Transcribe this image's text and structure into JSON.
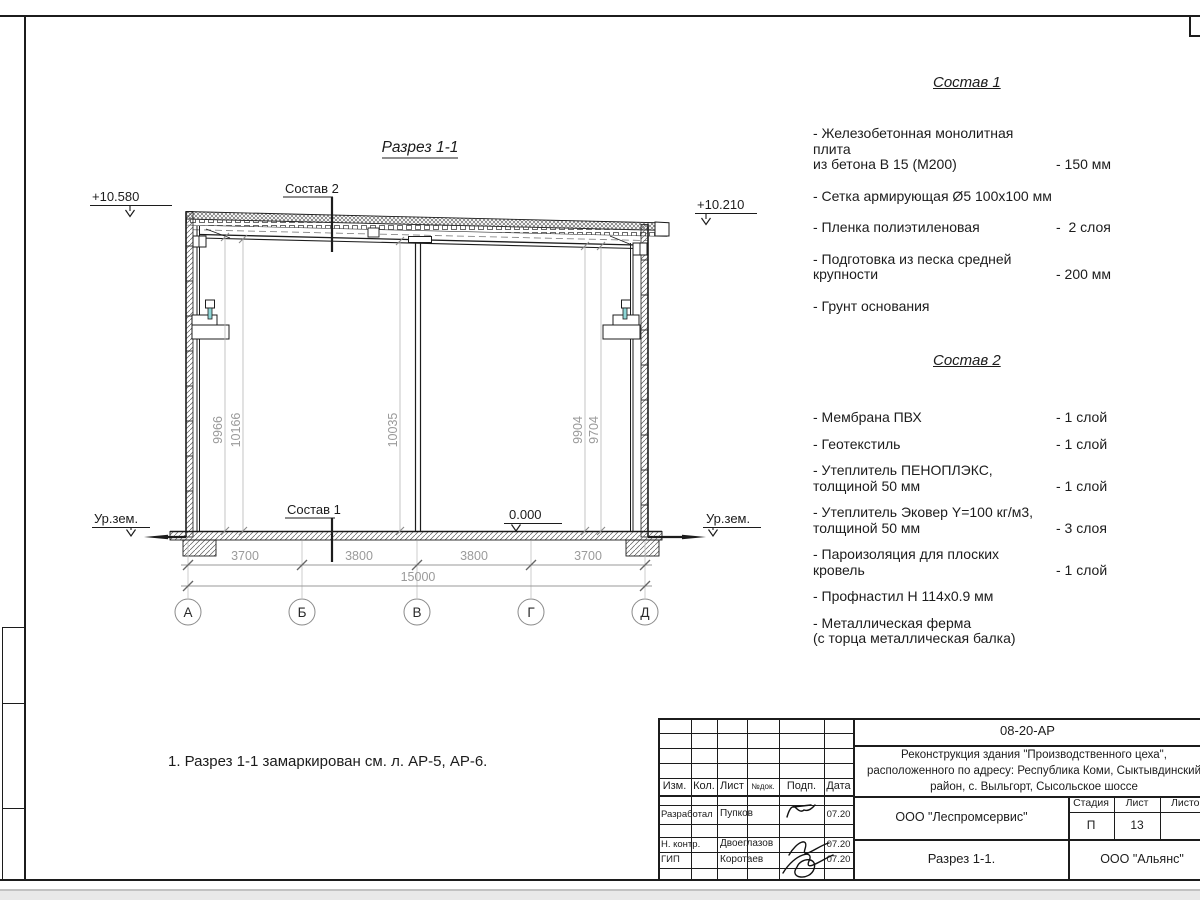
{
  "colors": {
    "line": "#1c1c1c",
    "dim_text": "#9a9a9a",
    "accent_teal": "#8ed6d6"
  },
  "drawing": {
    "title": "Разрез 1-1",
    "labels": {
      "sostav2_ref": "Состав 2",
      "sostav1_ref": "Состав 1",
      "elev_top_left": "+10.580",
      "elev_top_right": "+10.210",
      "elev_floor": "0.000",
      "ground_left": "Ур.зем.",
      "ground_right": "Ур.зем."
    },
    "heights": [
      "9966",
      "10166",
      "10035",
      "9904",
      "9704"
    ],
    "dims": [
      "3700",
      "3800",
      "3800",
      "3700"
    ],
    "total_dim": "15000",
    "axes": [
      "А",
      "Б",
      "В",
      "Г",
      "Д"
    ]
  },
  "sostav1": {
    "title": "Состав 1",
    "items": [
      {
        "name": "- Железобетонная  монолитная плита\nиз бетона В 15 (М200)",
        "value": "- 150 мм"
      },
      {
        "name": "- Сетка армирующая Ø5 100x100 мм",
        "value": ""
      },
      {
        "name": "- Пленка полиэтиленовая",
        "value": "-  2 слоя"
      },
      {
        "name": "- Подготовка из песка средней\nкрупности",
        "value": "- 200 мм"
      },
      {
        "name": "- Грунт основания",
        "value": ""
      }
    ]
  },
  "sostav2": {
    "title": "Состав 2",
    "items": [
      {
        "name": "- Мембрана ПВХ",
        "value": "- 1 слой"
      },
      {
        "name": "- Геотекстиль",
        "value": "- 1 слой"
      },
      {
        "name": "- Утеплитель ПЕНОПЛЭКС,\nтолщиной 50 мм",
        "value": "- 1 слой"
      },
      {
        "name": "- Утеплитель Эковер Y=100 кг/м3,\nтолщиной 50 мм",
        "value": "- 3 слоя"
      },
      {
        "name": "- Пароизоляция для плоских кровель",
        "value": "- 1 слой"
      },
      {
        "name": "- Профнастил Н 114x0.9 мм",
        "value": ""
      },
      {
        "name": "- Металлическая ферма\n(с торца металлическая балка)",
        "value": ""
      }
    ]
  },
  "note": "1. Разрез 1-1 замаркирован см. л. АР-5, АР-6.",
  "titleblock": {
    "doc_number": "08-20-АР",
    "project": "Реконструкция здания \"Производственного цеха\",\nрасположенного по адресу: Республика Коми, Сыктывдинский\nрайон, с. Выльгорт, Сысольское шоссе",
    "header_cols": [
      "Изм.",
      "Кол.",
      "Лист",
      "№док.",
      "Подп.",
      "Дата"
    ],
    "rows": [
      {
        "role": "Разработал",
        "name": "Пупков",
        "date": "07.20"
      },
      {
        "role": "Н. контр.",
        "name": "Двоеглазов",
        "date": "07.20"
      },
      {
        "role": "ГИП",
        "name": "Коротаев",
        "date": "07.20"
      }
    ],
    "org": "ООО \"Леспромсервис\"",
    "stage_label": "Стадия",
    "sheet_label": "Лист",
    "sheets_label": "Листов",
    "stage": "П",
    "sheet": "13",
    "sheets": "",
    "sheet_title": "Разрез 1-1.",
    "contractor": "ООО \"Альянс\""
  }
}
